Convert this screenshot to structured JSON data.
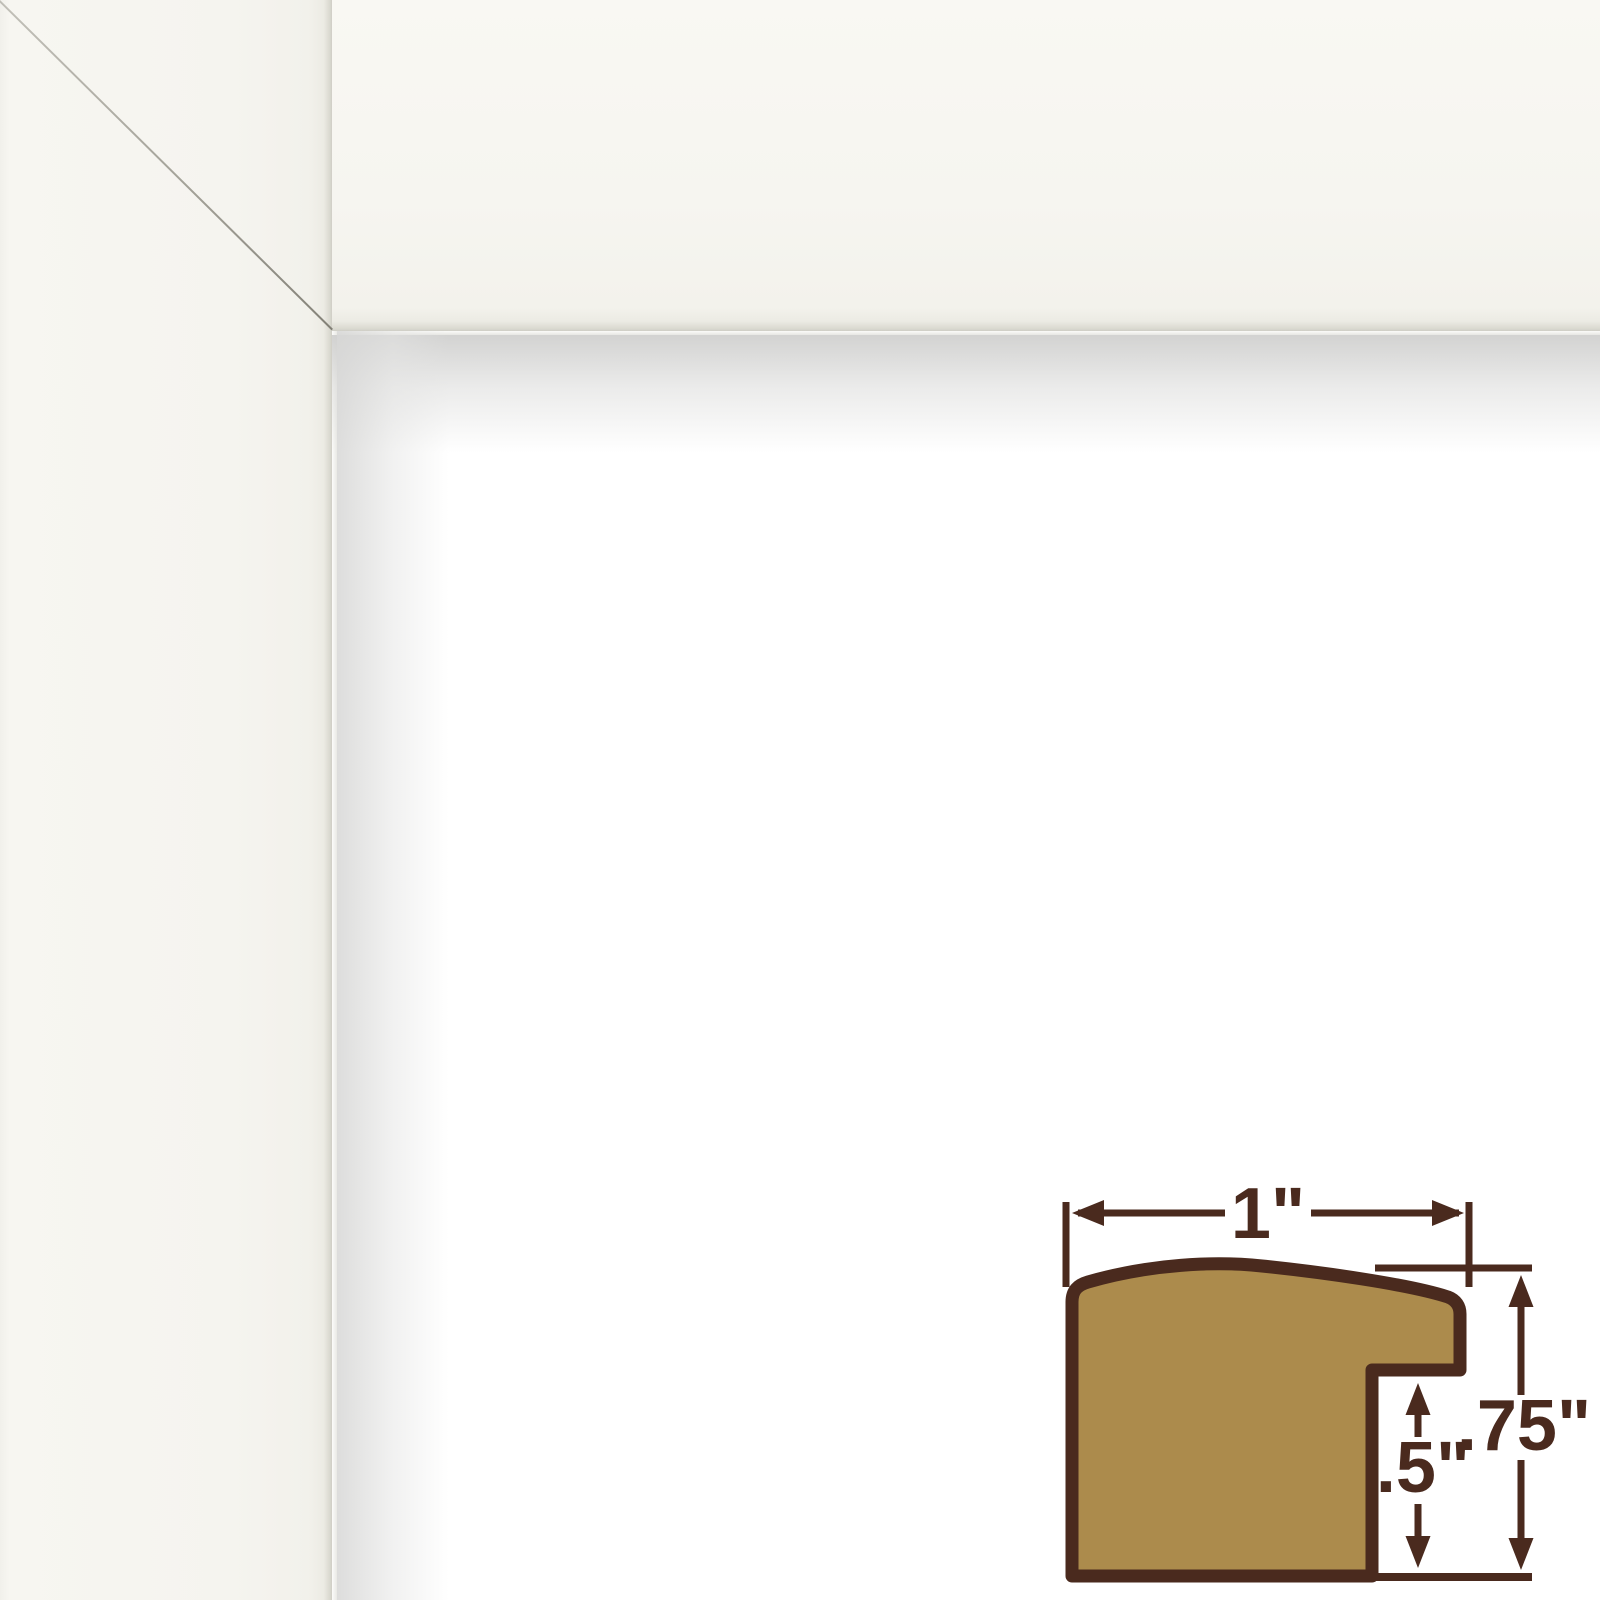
{
  "photo": {
    "frame_finish_color": "#F5F4EF",
    "opening_color": "#FFFFFF",
    "shadow_color": "#D0D0CF",
    "miter_seam_color": "#96948A"
  },
  "diagram": {
    "moulding_fill": "#AC8B4C",
    "moulding_outline": "#4A2A1E",
    "dimension_color": "#4A2A1E",
    "dimensions": {
      "width": "1\"",
      "rabbet_depth": ".5\"",
      "height": ".75\""
    }
  }
}
